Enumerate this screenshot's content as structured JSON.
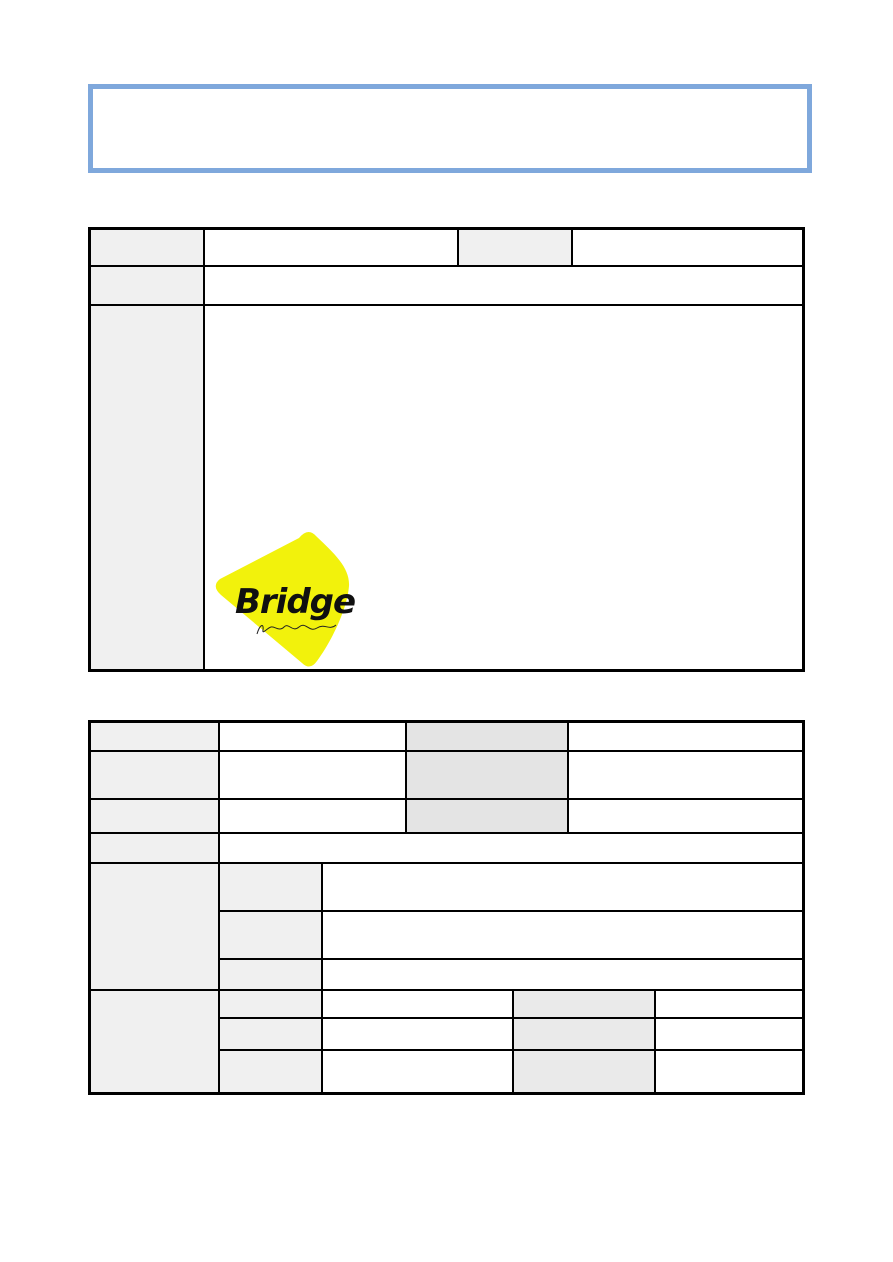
{
  "page": {
    "background": "#ffffff",
    "accent_blue": "#7FA8DC",
    "border_black": "#000000",
    "fill_light_gray": "#f0f0f0",
    "fill_mid_gray": "#e4e4e4",
    "fill_soft_gray": "#eaeaea"
  },
  "header_box": {
    "content": ""
  },
  "logo": {
    "text": "Bridge",
    "shape": "rounded-triangle-pick",
    "fill": "#F2F20C",
    "text_color": "#101010",
    "signature": "handwritten-script-scribble"
  },
  "table1": {
    "rows": [
      {
        "cells": [
          "",
          "",
          "",
          ""
        ]
      },
      {
        "cells": [
          "",
          ""
        ]
      },
      {
        "cells": [
          "",
          ""
        ]
      }
    ]
  },
  "table2": {
    "rows": [
      {
        "cells": [
          "",
          "",
          "",
          ""
        ]
      },
      {
        "cells": [
          "",
          "",
          "",
          ""
        ]
      },
      {
        "cells": [
          "",
          "",
          "",
          ""
        ]
      },
      {
        "cells": [
          "",
          ""
        ]
      }
    ],
    "group1": {
      "label": "",
      "subrows": [
        {
          "cells": [
            "",
            ""
          ]
        },
        {
          "cells": [
            "",
            ""
          ]
        },
        {
          "cells": [
            "",
            ""
          ]
        }
      ]
    },
    "group2": {
      "label": "",
      "subrows": [
        {
          "cells": [
            "",
            "",
            "",
            ""
          ]
        },
        {
          "cells": [
            "",
            "",
            "",
            ""
          ]
        },
        {
          "cells": [
            "",
            "",
            "",
            ""
          ]
        }
      ]
    }
  }
}
